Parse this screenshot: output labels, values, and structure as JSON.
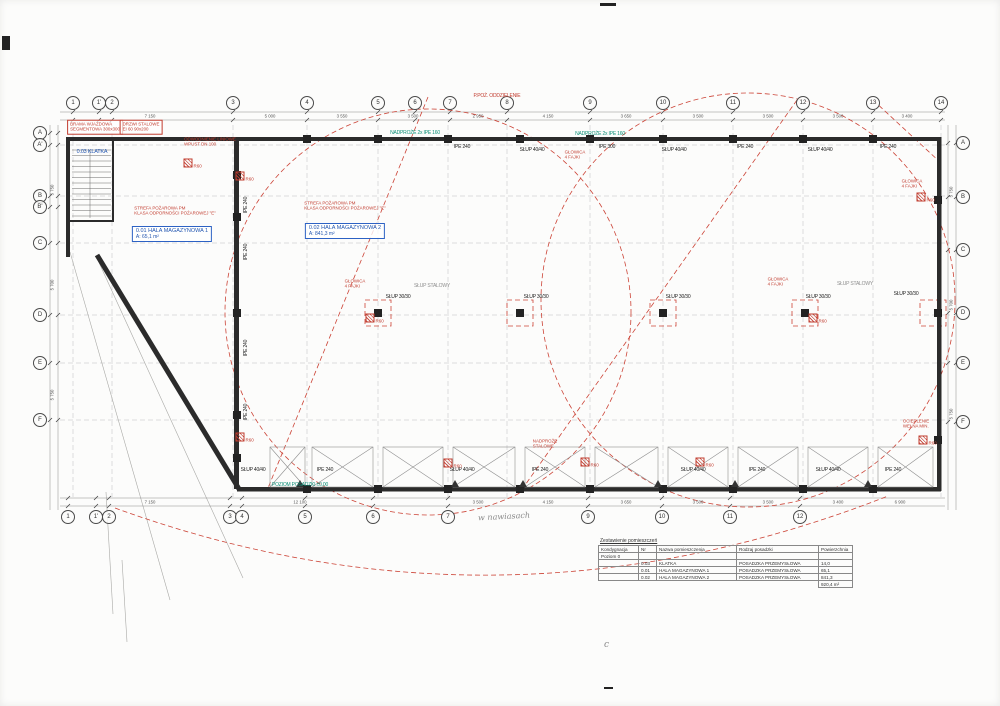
{
  "colors": {
    "accent_red": "#c13b2e",
    "teal": "#0d8f78",
    "blue": "#2356b0",
    "wall": "#2b2b2b"
  },
  "axes": {
    "top": [
      {
        "label": "1",
        "x": 73,
        "y": 103
      },
      {
        "label": "1'",
        "x": 99,
        "y": 103
      },
      {
        "label": "2",
        "x": 112,
        "y": 103
      },
      {
        "label": "3",
        "x": 233,
        "y": 103
      },
      {
        "label": "4",
        "x": 307,
        "y": 103
      },
      {
        "label": "5",
        "x": 378,
        "y": 103
      },
      {
        "label": "6",
        "x": 415,
        "y": 103
      },
      {
        "label": "7",
        "x": 450,
        "y": 103
      },
      {
        "label": "8",
        "x": 507,
        "y": 103
      },
      {
        "label": "9",
        "x": 590,
        "y": 103
      },
      {
        "label": "10",
        "x": 663,
        "y": 103
      },
      {
        "label": "11",
        "x": 733,
        "y": 103
      },
      {
        "label": "12",
        "x": 803,
        "y": 103
      },
      {
        "label": "13",
        "x": 873,
        "y": 103
      },
      {
        "label": "14",
        "x": 941,
        "y": 103
      }
    ],
    "bottom": [
      {
        "label": "1",
        "x": 68,
        "y": 517
      },
      {
        "label": "1'",
        "x": 96,
        "y": 517
      },
      {
        "label": "2",
        "x": 109,
        "y": 517
      },
      {
        "label": "3",
        "x": 230,
        "y": 517
      },
      {
        "label": "4",
        "x": 242,
        "y": 517
      },
      {
        "label": "5",
        "x": 305,
        "y": 517
      },
      {
        "label": "6",
        "x": 373,
        "y": 517
      },
      {
        "label": "7",
        "x": 448,
        "y": 517
      },
      {
        "label": "9",
        "x": 588,
        "y": 517
      },
      {
        "label": "10",
        "x": 662,
        "y": 517
      },
      {
        "label": "11",
        "x": 730,
        "y": 517
      },
      {
        "label": "12",
        "x": 800,
        "y": 517
      }
    ],
    "left": [
      {
        "label": "A",
        "x": 40,
        "y": 133
      },
      {
        "label": "A'",
        "x": 40,
        "y": 145
      },
      {
        "label": "B",
        "x": 40,
        "y": 196
      },
      {
        "label": "B'",
        "x": 40,
        "y": 207
      },
      {
        "label": "C",
        "x": 40,
        "y": 243
      },
      {
        "label": "D",
        "x": 40,
        "y": 315
      },
      {
        "label": "E",
        "x": 40,
        "y": 363
      },
      {
        "label": "F",
        "x": 40,
        "y": 420
      }
    ],
    "right": [
      {
        "label": "A",
        "x": 963,
        "y": 143
      },
      {
        "label": "B",
        "x": 963,
        "y": 197
      },
      {
        "label": "C",
        "x": 963,
        "y": 250
      },
      {
        "label": "D",
        "x": 963,
        "y": 313
      },
      {
        "label": "E",
        "x": 963,
        "y": 363
      },
      {
        "label": "F",
        "x": 963,
        "y": 422
      }
    ]
  },
  "rooms": [
    {
      "id": "0.02 HALA MAGAZYNOWA 2",
      "area": "A: 841,3 m²",
      "x": 345,
      "y": 231
    },
    {
      "id": "0.01 HALA MAGAZYNOWA 1",
      "area": "A: 65,1 m²",
      "x": 172,
      "y": 234
    }
  ],
  "fire_notes": [
    {
      "l1": "STREFA POŻAROWA PM",
      "l2": "KLASA ODPORNOŚCI POŻAROWEJ \"E\"",
      "x": 175,
      "y": 211
    },
    {
      "l1": "STREFA POŻAROWA PM",
      "l2": "KLASA ODPORNOŚCI POŻAROWEJ \"E\"",
      "x": 345,
      "y": 206
    }
  ],
  "red_boxes": [
    {
      "l1": "BRAMA WJAZDOWA",
      "l2": "SEGMENTOWA 300x300",
      "x": 95,
      "y": 127
    },
    {
      "l1": "DRZWI STALOWE",
      "l2": "EI 60 90x200",
      "x": 141,
      "y": 127
    }
  ],
  "red_notes": [
    {
      "l1": "GŁOWICA",
      "l2": "4 FAJKI",
      "x": 575,
      "y": 155
    },
    {
      "l1": "GŁOWICA",
      "l2": "4 FAJKI",
      "x": 355,
      "y": 284
    },
    {
      "l1": "GŁOWICA",
      "l2": "4 FAJKI",
      "x": 778,
      "y": 282
    },
    {
      "l1": "GŁOWICA",
      "l2": "4 FAJKI",
      "x": 912,
      "y": 184
    },
    {
      "l1": "OCIEPLENIE",
      "l2": "WEŁNA MIN.",
      "x": 916,
      "y": 424
    },
    {
      "l1": "ODWODNIENIE LINIOWE",
      "l2": "WPUST DN 100",
      "x": 210,
      "y": 142
    },
    {
      "l1": "NADPROŻE",
      "l2": "STALOWE",
      "x": 545,
      "y": 444
    }
  ],
  "markers": [
    {
      "label": "R60",
      "x": 240,
      "y": 176
    },
    {
      "label": "R60",
      "x": 240,
      "y": 437
    },
    {
      "label": "R60",
      "x": 370,
      "y": 318
    },
    {
      "label": "R60",
      "x": 813,
      "y": 318
    },
    {
      "label": "R60",
      "x": 921,
      "y": 197
    },
    {
      "label": "R60",
      "x": 923,
      "y": 440
    },
    {
      "label": "R60",
      "x": 585,
      "y": 462
    },
    {
      "label": "R60",
      "x": 700,
      "y": 462
    },
    {
      "label": "R60",
      "x": 448,
      "y": 463
    },
    {
      "label": "R60",
      "x": 188,
      "y": 163
    }
  ],
  "labels": {
    "black": [
      {
        "t": "IPE 240",
        "x": 462,
        "y": 147
      },
      {
        "t": "SŁUP 40/40",
        "x": 532,
        "y": 150
      },
      {
        "t": "IPE 300",
        "x": 607,
        "y": 147
      },
      {
        "t": "SŁUP 40/40",
        "x": 674,
        "y": 150
      },
      {
        "t": "IPE 240",
        "x": 745,
        "y": 147
      },
      {
        "t": "SŁUP 40/40",
        "x": 820,
        "y": 150
      },
      {
        "t": "IPE 240",
        "x": 888,
        "y": 147
      },
      {
        "t": "IPE 240",
        "x": 246,
        "y": 205,
        "r": -90
      },
      {
        "t": "IPE 240",
        "x": 246,
        "y": 252,
        "r": -90
      },
      {
        "t": "IPE 240",
        "x": 246,
        "y": 348,
        "r": -90
      },
      {
        "t": "IPE 240",
        "x": 246,
        "y": 412,
        "r": -90
      },
      {
        "t": "SŁUP 30/30",
        "x": 398,
        "y": 297
      },
      {
        "t": "SŁUP 30/30",
        "x": 536,
        "y": 297
      },
      {
        "t": "SŁUP 30/30",
        "x": 678,
        "y": 297
      },
      {
        "t": "SŁUP 30/30",
        "x": 818,
        "y": 297
      },
      {
        "t": "SŁUP 30/30",
        "x": 906,
        "y": 294
      },
      {
        "t": "SŁUP 40/40",
        "x": 253,
        "y": 470
      },
      {
        "t": "IPE 240",
        "x": 325,
        "y": 470
      },
      {
        "t": "SŁUP 40/40",
        "x": 462,
        "y": 470
      },
      {
        "t": "IPE 240",
        "x": 540,
        "y": 470
      },
      {
        "t": "SŁUP 40/40",
        "x": 693,
        "y": 470
      },
      {
        "t": "IPE 240",
        "x": 757,
        "y": 470
      },
      {
        "t": "SŁUP 40/40",
        "x": 828,
        "y": 470
      },
      {
        "t": "IPE 240",
        "x": 893,
        "y": 470
      }
    ],
    "red": [
      {
        "t": "P.POŻ. ODDZIELENIE",
        "x": 497,
        "y": 96
      }
    ],
    "teal": [
      {
        "t": "NADPROŻE 2x IPE 160",
        "x": 415,
        "y": 133
      },
      {
        "t": "NADPROŻE 2x IPE 160",
        "x": 600,
        "y": 134
      },
      {
        "t": "POZIOM POSADZKI ±0,00",
        "x": 300,
        "y": 485
      }
    ],
    "gray": [
      {
        "t": "SŁUP STALOWY",
        "x": 432,
        "y": 286
      },
      {
        "t": "SŁUP STALOWY",
        "x": 855,
        "y": 284
      }
    ],
    "blue": [
      {
        "t": "0.03 KLATKA",
        "x": 92,
        "y": 152
      }
    ]
  },
  "dims": {
    "all": [
      {
        "t": "7 150",
        "x": 150,
        "y": 116
      },
      {
        "t": "5 000",
        "x": 270,
        "y": 116
      },
      {
        "t": "3 550",
        "x": 342,
        "y": 116
      },
      {
        "t": "3 500",
        "x": 413,
        "y": 116
      },
      {
        "t": "2 950",
        "x": 478,
        "y": 116
      },
      {
        "t": "4 150",
        "x": 548,
        "y": 116
      },
      {
        "t": "3 650",
        "x": 626,
        "y": 116
      },
      {
        "t": "3 500",
        "x": 698,
        "y": 116
      },
      {
        "t": "3 500",
        "x": 768,
        "y": 116
      },
      {
        "t": "3 500",
        "x": 838,
        "y": 116
      },
      {
        "t": "3 400",
        "x": 907,
        "y": 116
      },
      {
        "t": "7 150",
        "x": 150,
        "y": 502
      },
      {
        "t": "12 100",
        "x": 300,
        "y": 502
      },
      {
        "t": "3 500",
        "x": 478,
        "y": 502
      },
      {
        "t": "4 150",
        "x": 548,
        "y": 502
      },
      {
        "t": "3 650",
        "x": 626,
        "y": 502
      },
      {
        "t": "3 500",
        "x": 698,
        "y": 502
      },
      {
        "t": "3 500",
        "x": 768,
        "y": 502
      },
      {
        "t": "3 400",
        "x": 838,
        "y": 502
      },
      {
        "t": "6 900",
        "x": 900,
        "y": 502
      },
      {
        "t": "5 750",
        "x": 52,
        "y": 190,
        "r": -90
      },
      {
        "t": "5 700",
        "x": 52,
        "y": 285,
        "r": -90
      },
      {
        "t": "5 750",
        "x": 52,
        "y": 395,
        "r": -90
      },
      {
        "t": "5 750",
        "x": 951,
        "y": 192,
        "r": -90
      },
      {
        "t": "5 700",
        "x": 951,
        "y": 305,
        "r": -90
      },
      {
        "t": "5 750",
        "x": 951,
        "y": 414,
        "r": -90
      }
    ]
  },
  "handwritten": {
    "note": "w nawiasach",
    "mark": "c"
  },
  "schedule": {
    "title": "Zestawienie pomieszczeń",
    "headers": [
      "Kondygnacja",
      "Nr",
      "Nazwa pomieszczenia",
      "Rodzaj posadzki",
      "Powierzchnia"
    ],
    "level": "Poziom 0",
    "rows": [
      {
        "nr": "0.03",
        "name": "KLATKA",
        "floor": "POSADZKA PRZEMYSŁOWA",
        "area": "14,0"
      },
      {
        "nr": "0.01",
        "name": "HALA MAGAZYNOWA 1",
        "floor": "POSADZKA PRZEMYSŁOWA",
        "area": "65,1"
      },
      {
        "nr": "0.02",
        "name": "HALA MAGAZYNOWA 2",
        "floor": "POSADZKA PRZEMYSŁOWA",
        "area": "841,3"
      }
    ],
    "total": "920,4 m²"
  }
}
